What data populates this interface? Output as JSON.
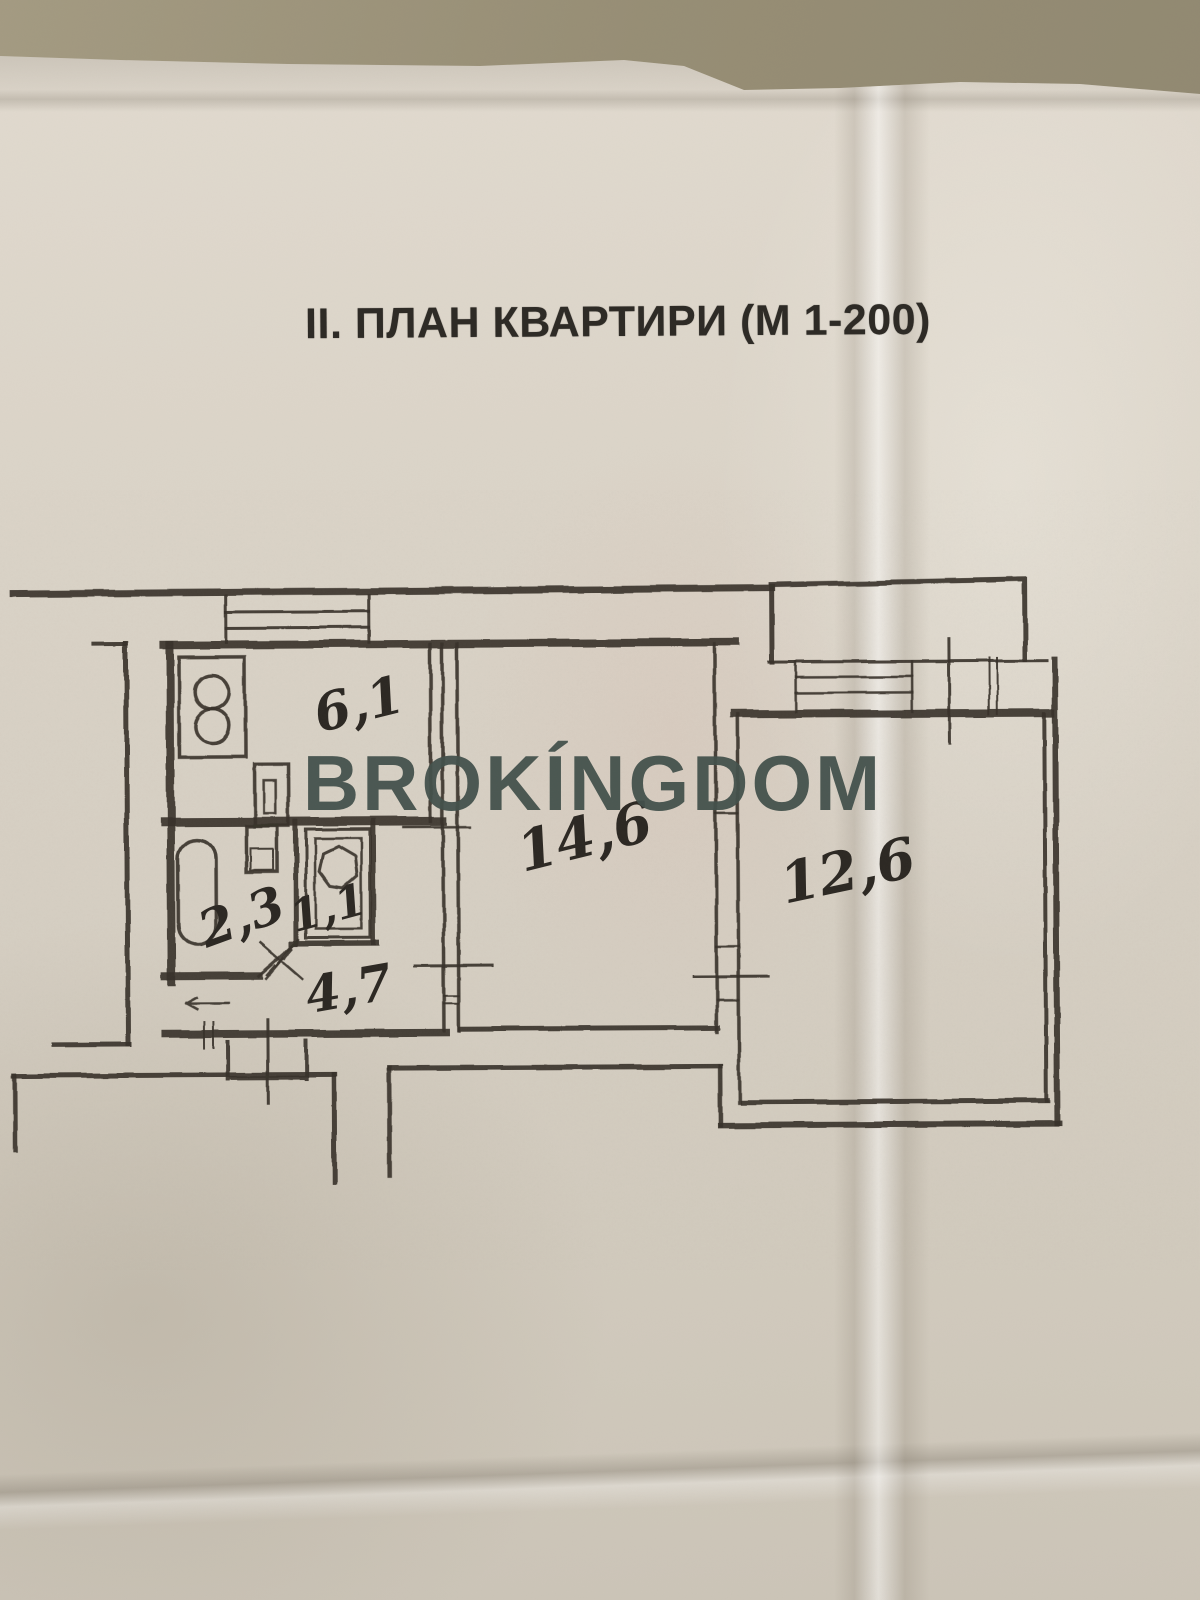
{
  "document": {
    "title": "II. ПЛАН КВАРТИРИ (М 1-200)",
    "watermark": "BROKÍNGDOM"
  },
  "floor_plan": {
    "scale_note": "М 1-200",
    "rooms": [
      {
        "id": "kitchen",
        "area_label": "6,1"
      },
      {
        "id": "living-room",
        "area_label": "14,6"
      },
      {
        "id": "bedroom",
        "area_label": "12,6"
      },
      {
        "id": "bathroom",
        "area_label": "2,3"
      },
      {
        "id": "wc",
        "area_label": "1,1"
      },
      {
        "id": "hallway",
        "area_label": "4,7"
      }
    ],
    "fixtures": [
      "stove",
      "kitchen-sink",
      "washbasin",
      "bathtub",
      "toilet"
    ],
    "features": [
      "kitchen-window",
      "balcony-window",
      "balcony",
      "door-swing-mark",
      "entrance-door"
    ]
  },
  "colors": {
    "ink": "#39342d",
    "paper": "#d7d0c4",
    "background": "#978e75",
    "watermark": "#43514c",
    "title_text": "#2d2a25"
  }
}
